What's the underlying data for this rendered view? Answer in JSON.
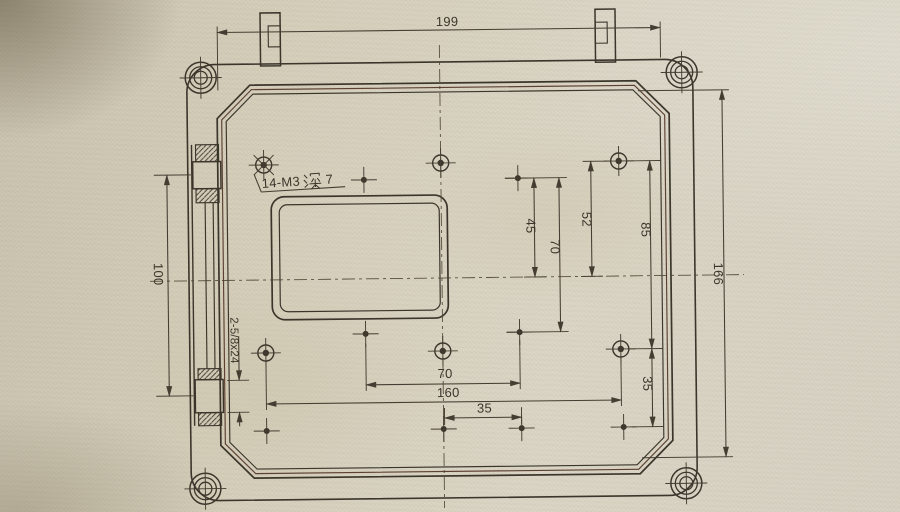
{
  "labels": {
    "thread_note_full": "14-M3深7",
    "thread_note_prefix": "14-M3",
    "thread_note_suffix": "7",
    "hinge_note": "2-5/8x24"
  },
  "dimensions": {
    "top_width": "199",
    "right_height": "166",
    "left_hinge_spacing": "100",
    "hole_offset_45": "45",
    "hole_span_70_vertical": "70",
    "hole_offset_52": "52",
    "hole_span_85": "85",
    "hole_span_70_horizontal": "70",
    "hole_span_160": "160",
    "hole_span_35_bottom": "35",
    "hole_span_35_right": "35"
  },
  "colors": {
    "paper": "#d5cfbe",
    "ink": "#3b352b",
    "ink_warm": "#5d4033"
  }
}
